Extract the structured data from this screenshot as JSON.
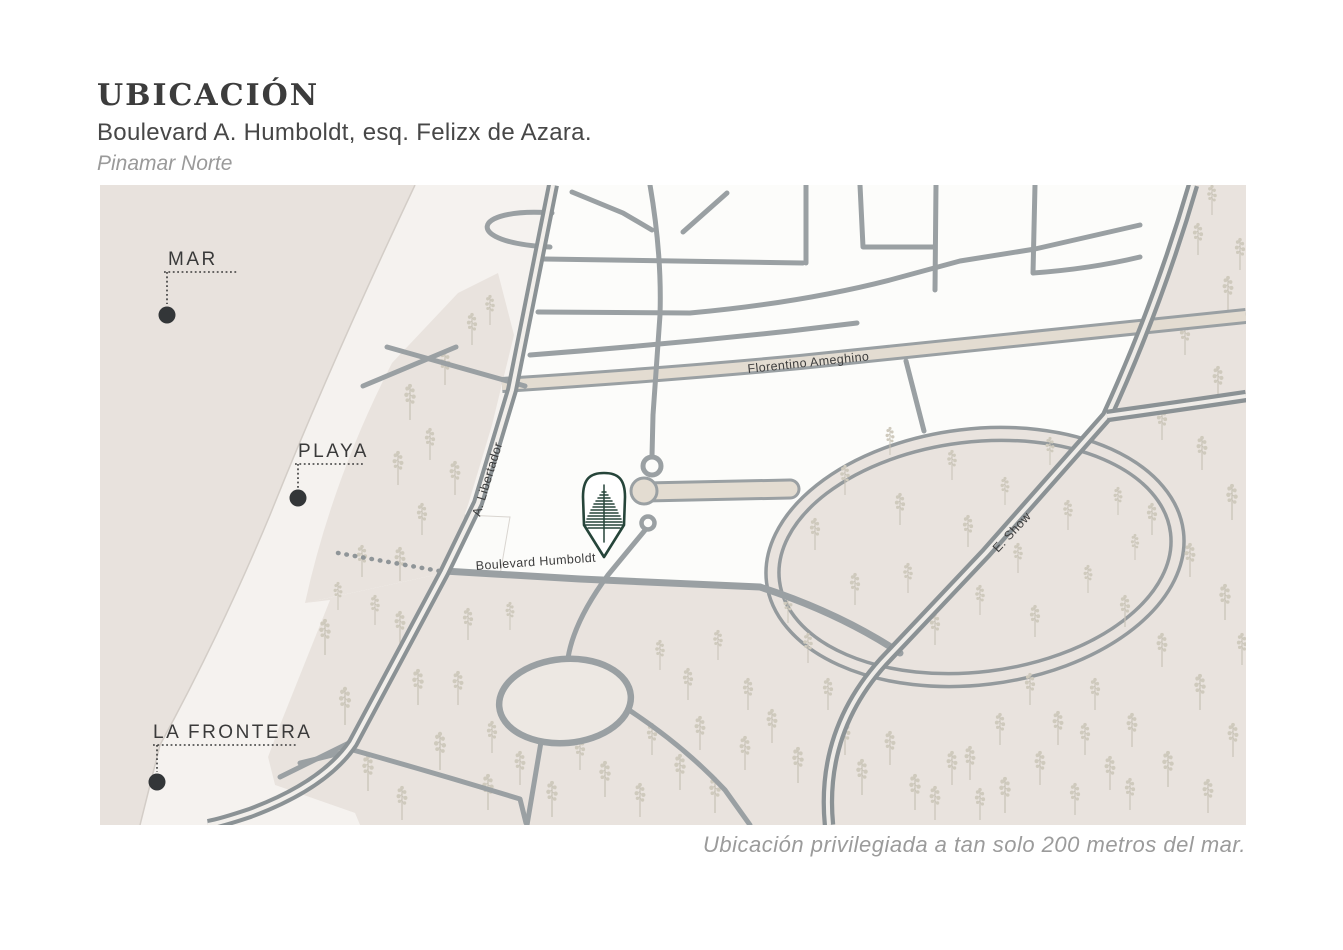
{
  "header": {
    "title": "UBICACIÓN",
    "subtitle": "Boulevard A. Humboldt, esq. Felizx de Azara.",
    "area": "Pinamar Norte"
  },
  "caption": "Ubicación privilegiada a tan solo 200 metros del mar.",
  "map": {
    "labels": {
      "mar": "MAR",
      "playa": "PLAYA",
      "la_frontera": "LA FRONTERA",
      "a_libertador": "A. Libertador",
      "florentino_ameghino": "Florentino Ameghino",
      "boulevard_humboldt": "Boulevard Humboldt",
      "e_show": "E. Show"
    },
    "marker": {
      "icon": "pine-tree-pin",
      "color": "#26453a"
    },
    "colors": {
      "sea": "#e8e2dd",
      "beach": "#f5f2ef",
      "forest": "#e9e3de",
      "city": "#fcfcfa",
      "road": "#979da0",
      "road_major": "#8b9295",
      "avenue_fill": "#e3dcd1",
      "tree": "#c9c4b8",
      "label": "#3b3b3b",
      "pin_green": "#26453a",
      "muted_text": "#9b9b9b",
      "title_text": "#3c3c3c"
    },
    "trees": [
      [
        310,
        235,
        0.9
      ],
      [
        298,
        300,
        0.85
      ],
      [
        330,
        275,
        0.8
      ],
      [
        345,
        200,
        0.85
      ],
      [
        372,
        160,
        0.8
      ],
      [
        390,
        140,
        0.75
      ],
      [
        355,
        310,
        0.85
      ],
      [
        322,
        350,
        0.8
      ],
      [
        262,
        392,
        0.8
      ],
      [
        300,
        396,
        0.85
      ],
      [
        225,
        470,
        0.9
      ],
      [
        245,
        540,
        0.95
      ],
      [
        268,
        606,
        0.9
      ],
      [
        300,
        460,
        0.85
      ],
      [
        318,
        520,
        0.9
      ],
      [
        340,
        585,
        0.95
      ],
      [
        302,
        635,
        0.85
      ],
      [
        368,
        455,
        0.8
      ],
      [
        388,
        625,
        0.9
      ],
      [
        420,
        600,
        0.85
      ],
      [
        452,
        632,
        0.9
      ],
      [
        480,
        585,
        0.8
      ],
      [
        505,
        612,
        0.9
      ],
      [
        540,
        632,
        0.85
      ],
      [
        552,
        570,
        0.8
      ],
      [
        580,
        605,
        0.9
      ],
      [
        600,
        565,
        0.85
      ],
      [
        615,
        628,
        0.9
      ],
      [
        645,
        585,
        0.85
      ],
      [
        560,
        485,
        0.75
      ],
      [
        588,
        515,
        0.8
      ],
      [
        618,
        475,
        0.75
      ],
      [
        648,
        525,
        0.8
      ],
      [
        672,
        558,
        0.85
      ],
      [
        698,
        598,
        0.9
      ],
      [
        708,
        478,
        0.75
      ],
      [
        728,
        525,
        0.8
      ],
      [
        688,
        438,
        0.7
      ],
      [
        745,
        570,
        0.85
      ],
      [
        762,
        610,
        0.9
      ],
      [
        790,
        580,
        0.85
      ],
      [
        815,
        625,
        0.9
      ],
      [
        852,
        600,
        0.85
      ],
      [
        880,
        635,
        0.8
      ],
      [
        238,
        425,
        0.7
      ],
      [
        275,
        440,
        0.75
      ],
      [
        410,
        445,
        0.7
      ],
      [
        358,
        520,
        0.85
      ],
      [
        392,
        568,
        0.8
      ],
      [
        715,
        365,
        0.8
      ],
      [
        745,
        310,
        0.75
      ],
      [
        755,
        420,
        0.8
      ],
      [
        790,
        270,
        0.7
      ],
      [
        800,
        340,
        0.8
      ],
      [
        808,
        408,
        0.75
      ],
      [
        835,
        460,
        0.8
      ],
      [
        852,
        295,
        0.75
      ],
      [
        868,
        362,
        0.8
      ],
      [
        880,
        430,
        0.75
      ],
      [
        905,
        320,
        0.7
      ],
      [
        918,
        388,
        0.75
      ],
      [
        935,
        452,
        0.8
      ],
      [
        950,
        280,
        0.7
      ],
      [
        968,
        345,
        0.75
      ],
      [
        988,
        408,
        0.7
      ],
      [
        1018,
        330,
        0.7
      ],
      [
        1035,
        375,
        0.65
      ],
      [
        930,
        520,
        0.8
      ],
      [
        958,
        560,
        0.85
      ],
      [
        900,
        560,
        0.8
      ],
      [
        870,
        595,
        0.85
      ],
      [
        905,
        628,
        0.9
      ],
      [
        940,
        600,
        0.85
      ],
      [
        975,
        630,
        0.8
      ],
      [
        985,
        570,
        0.8
      ],
      [
        1010,
        605,
        0.85
      ],
      [
        835,
        635,
        0.85
      ],
      [
        1098,
        70,
        0.8
      ],
      [
        1128,
        125,
        0.85
      ],
      [
        1085,
        170,
        0.8
      ],
      [
        1118,
        215,
        0.85
      ],
      [
        1062,
        255,
        0.8
      ],
      [
        1102,
        285,
        0.85
      ],
      [
        1132,
        335,
        0.9
      ],
      [
        1052,
        350,
        0.8
      ],
      [
        1090,
        392,
        0.85
      ],
      [
        1125,
        435,
        0.9
      ],
      [
        1025,
        442,
        0.8
      ],
      [
        1062,
        482,
        0.85
      ],
      [
        1100,
        525,
        0.9
      ],
      [
        1133,
        572,
        0.85
      ],
      [
        995,
        525,
        0.8
      ],
      [
        1032,
        562,
        0.85
      ],
      [
        1068,
        602,
        0.9
      ],
      [
        1108,
        628,
        0.85
      ],
      [
        1142,
        480,
        0.8
      ],
      [
        1030,
        625,
        0.8
      ],
      [
        1112,
        30,
        0.75
      ],
      [
        1140,
        85,
        0.8
      ]
    ]
  }
}
